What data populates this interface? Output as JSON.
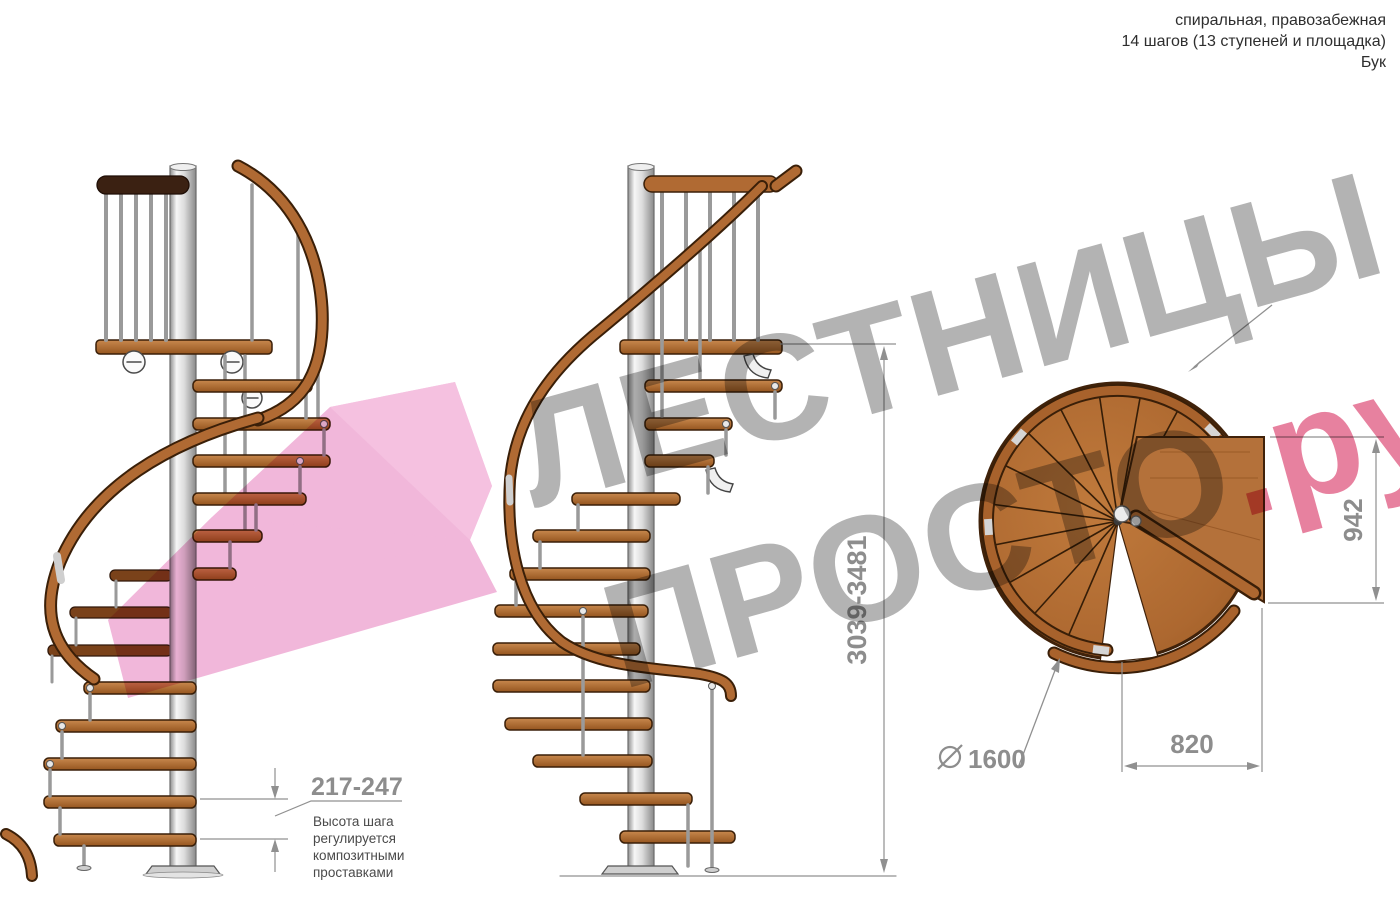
{
  "header": {
    "line1": "спиральная, правозабежная",
    "line2": "14 шагов (13 ступеней и площадка)",
    "line3": "Бук"
  },
  "watermark": {
    "line1": "ЛЕСТНИЦЫ",
    "line2_gray": "ПРОСТО",
    "line2_pink": ".ру",
    "gray_color": "#9e9e9e",
    "pink_color": "#e0557e"
  },
  "dimensions": {
    "total_height": "3039-3481",
    "step_height": "217-247",
    "step_height_note": [
      "Высота шага",
      "регулируется",
      "композитными",
      "проставками"
    ],
    "plan_depth": "942",
    "plan_landing_width": "820",
    "diameter_value": "1600"
  },
  "colors": {
    "wood": "#b06c33",
    "wood_dark_outline": "#3a1f08",
    "dark_rail": "#3b2112",
    "metal_pole": "#d9d9d9",
    "dimension_gray": "#8d8d8d",
    "watermark_pink": "#e0557e",
    "arrow_pink": "#efaad3"
  }
}
